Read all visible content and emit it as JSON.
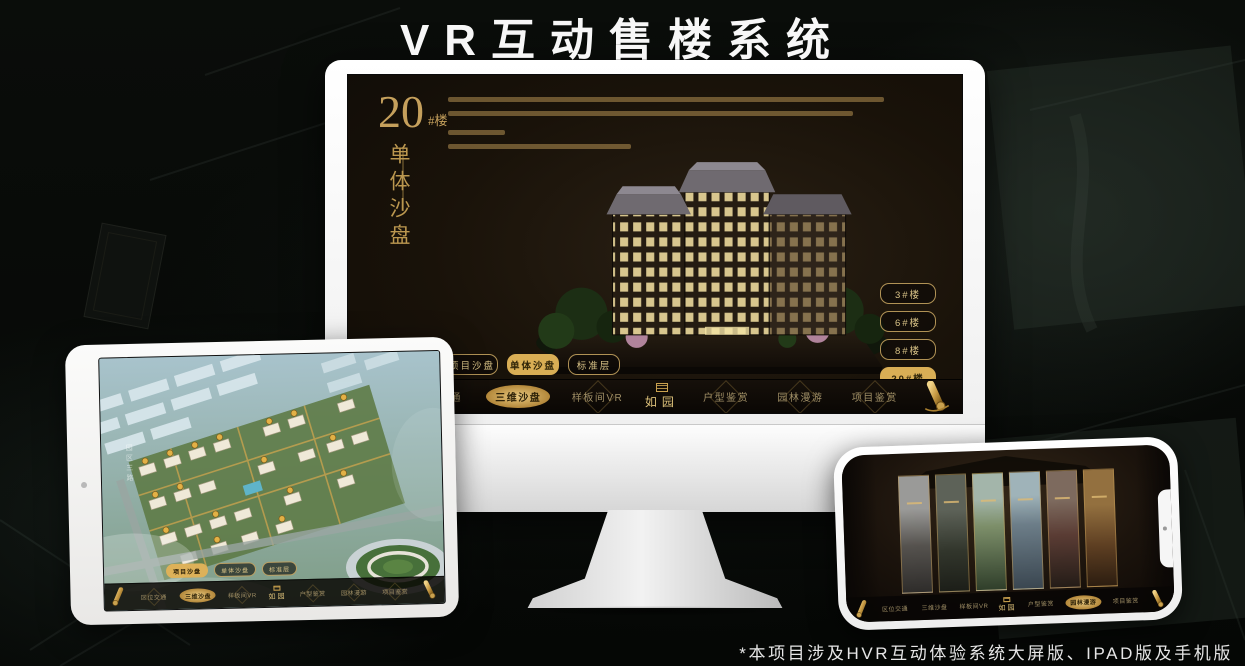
{
  "page": {
    "title": "VR互动售楼系统",
    "footnote": "*本项目涉及HVR互动体验系统大屏版、IPAD版及手机版"
  },
  "colors": {
    "gold": "#cfa558",
    "gold_active": "#d9ae55",
    "screen_bg": "#191209"
  },
  "headline": {
    "number": "20",
    "unit": "#楼",
    "subtitle": "单体沙盘"
  },
  "tabs": [
    "项目沙盘",
    "单体沙盘",
    "标准层"
  ],
  "floors": [
    "3#楼",
    "6#楼",
    "8#楼",
    "20#楼"
  ],
  "nav": {
    "items": [
      "区位交通",
      "三维沙盘",
      "样板间VR",
      "户型鉴赏",
      "园林漫游",
      "项目鉴赏"
    ],
    "logo": "如园"
  },
  "ipad": {
    "road_label": "园区三路"
  }
}
